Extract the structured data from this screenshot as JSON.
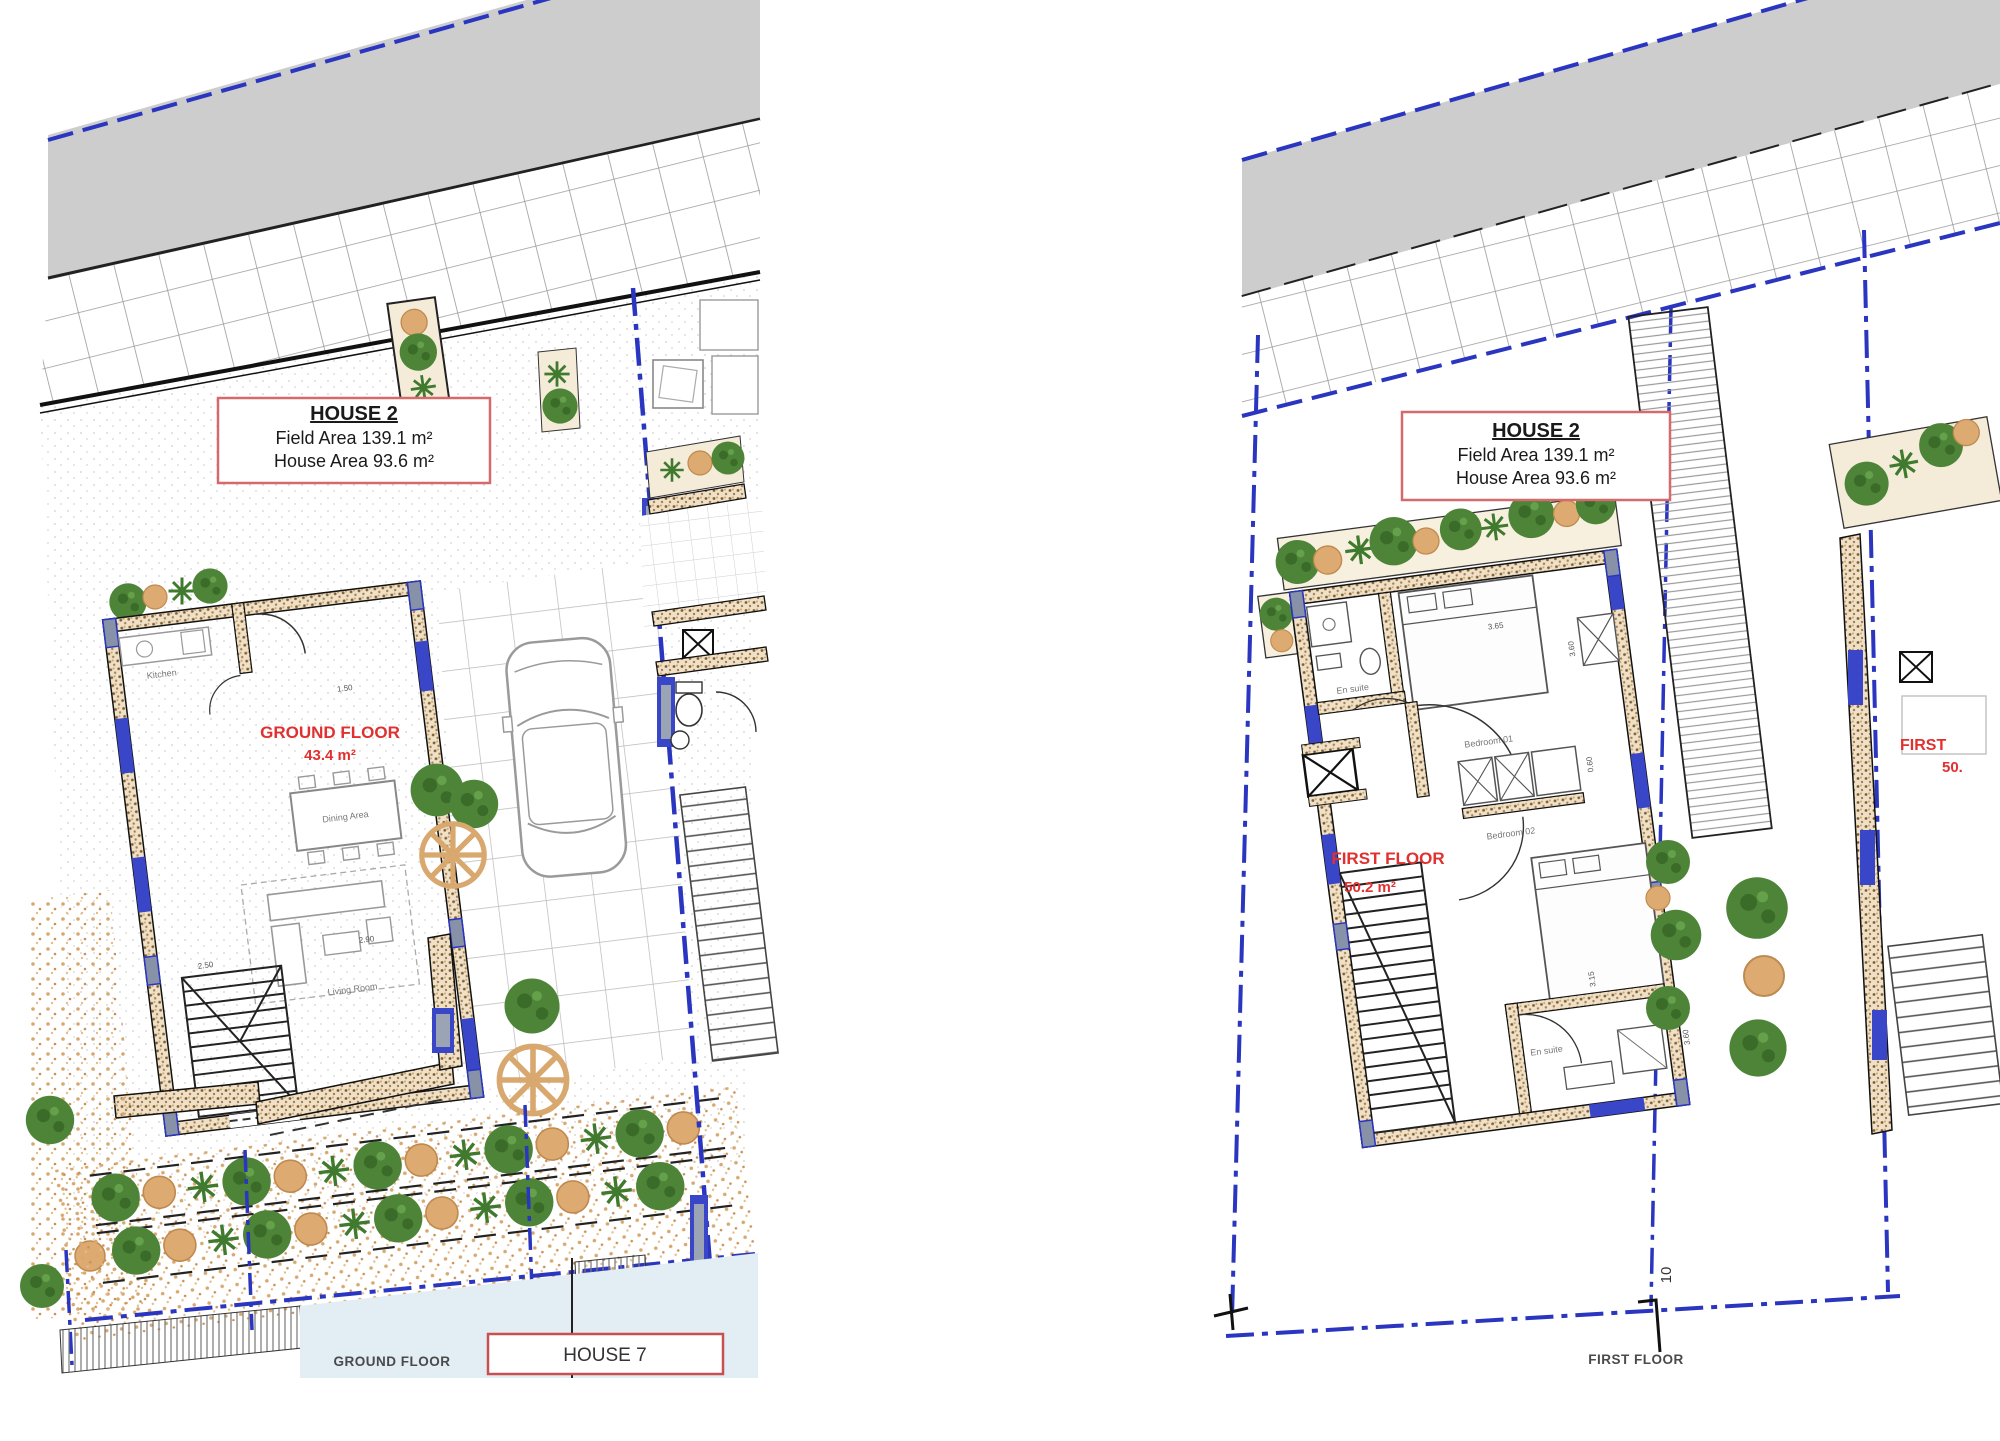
{
  "left_plan": {
    "house_label": {
      "title": "HOUSE 2",
      "field_area": "Field Area 139.1 m²",
      "house_area": "House Area 93.6 m²"
    },
    "floor_label": {
      "name": "GROUND FLOOR",
      "area": "43.4 m²"
    },
    "rooms": {
      "kitchen": "Kitchen",
      "dining": "Dining Area",
      "living": "Living Room"
    },
    "dims": [
      "1.50",
      "2.90",
      "2.50"
    ],
    "caption": "GROUND FLOOR",
    "neighbor_house_label": "HOUSE 7"
  },
  "right_plan": {
    "house_label": {
      "title": "HOUSE 2",
      "field_area": "Field Area 139.1 m²",
      "house_area": "House Area 93.6 m²"
    },
    "floor_label": {
      "name": "FIRST FLOOR",
      "area": "50.2 m²"
    },
    "rooms": {
      "ensuite_top": "En suite",
      "bedroom_01": "Bedroom 01",
      "bedroom_02": "Bedroom 02",
      "ensuite_bottom": "En suite"
    },
    "dims": [
      "3.65",
      "3.60",
      "0.60",
      "3.15",
      "3.60"
    ],
    "caption": "FIRST FLOOR",
    "lot_number": "10",
    "neighbor_floor_label": {
      "line1": "FIRST",
      "line2": "50."
    }
  },
  "colors": {
    "boundary_blue": "#2a35c0",
    "window_blue": "#3a46c8",
    "label_red": "#e03030",
    "box_border_red": "#d46a6a",
    "road_gray": "#cdcdcd",
    "tree_green": "#4d8438",
    "tree_tan": "#ddab72"
  }
}
